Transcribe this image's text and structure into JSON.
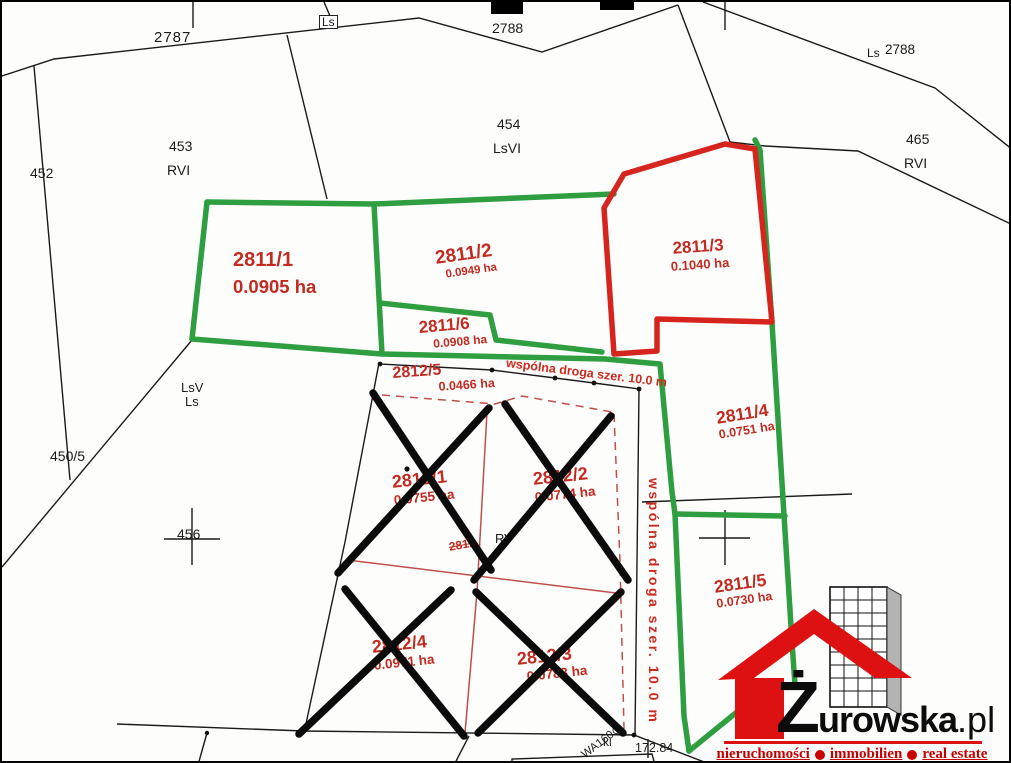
{
  "map": {
    "labels": {
      "l2787": "2787",
      "ls_box": "Ls",
      "l2788_top": "2788",
      "ls_right": "Ls",
      "l2788_right": "2788",
      "l452": "452",
      "l453": "453",
      "l453_class": "RVI",
      "l454": "454",
      "l454_class": "LsVI",
      "l465": "465",
      "l465_class": "RVI",
      "lsv_1": "LsV",
      "lsv_2": "Ls",
      "l450_5": "450/5",
      "l456": "456",
      "l_rv": "RV",
      "l2812_struck": "2812",
      "l_kl": "kl",
      "l_meas": "172.84",
      "l_wa": "WA160⊙"
    },
    "parcels": {
      "g1": {
        "id": "2811/1",
        "area": "0.0905 ha"
      },
      "g2": {
        "id": "2811/2",
        "area": "0.0949 ha"
      },
      "g6": {
        "id": "2811/6",
        "area": "0.0908 ha"
      },
      "g3": {
        "id": "2811/3",
        "area": "0.1040 ha"
      },
      "g4": {
        "id": "2811/4",
        "area": "0.0751 ha"
      },
      "g5": {
        "id": "2811/5",
        "area": "0.0730 ha"
      },
      "r5": {
        "id": "2812/5",
        "area": "0.0466 ha"
      },
      "r1": {
        "id": "2812/1",
        "area": "0.0755 ha"
      },
      "r2": {
        "id": "2812/2",
        "area": "0.0774 ha"
      },
      "r4": {
        "id": "2812/4",
        "area": "0.0971 ha"
      },
      "r3": {
        "id": "2812/3",
        "area": "0.0783 ha"
      }
    },
    "road_label_horizontal": "wspólna droga szer. 10.0 m",
    "road_label_vertical": "wspólna droga szer. 10.0 m",
    "colors": {
      "boundary_green": "#2f9e41",
      "boundary_red": "#d6251f",
      "label_red": "#c22b21",
      "line_black": "#1a1a1a",
      "subdivision_red": "#bf4f48",
      "logo_red": "#dd1111"
    }
  },
  "logo": {
    "initial": "Ż",
    "name_rest": "urowska",
    "tld": ".pl",
    "tagline": {
      "w1": "nieruchomości",
      "w2": "immobilien",
      "w3": "real estate"
    }
  }
}
